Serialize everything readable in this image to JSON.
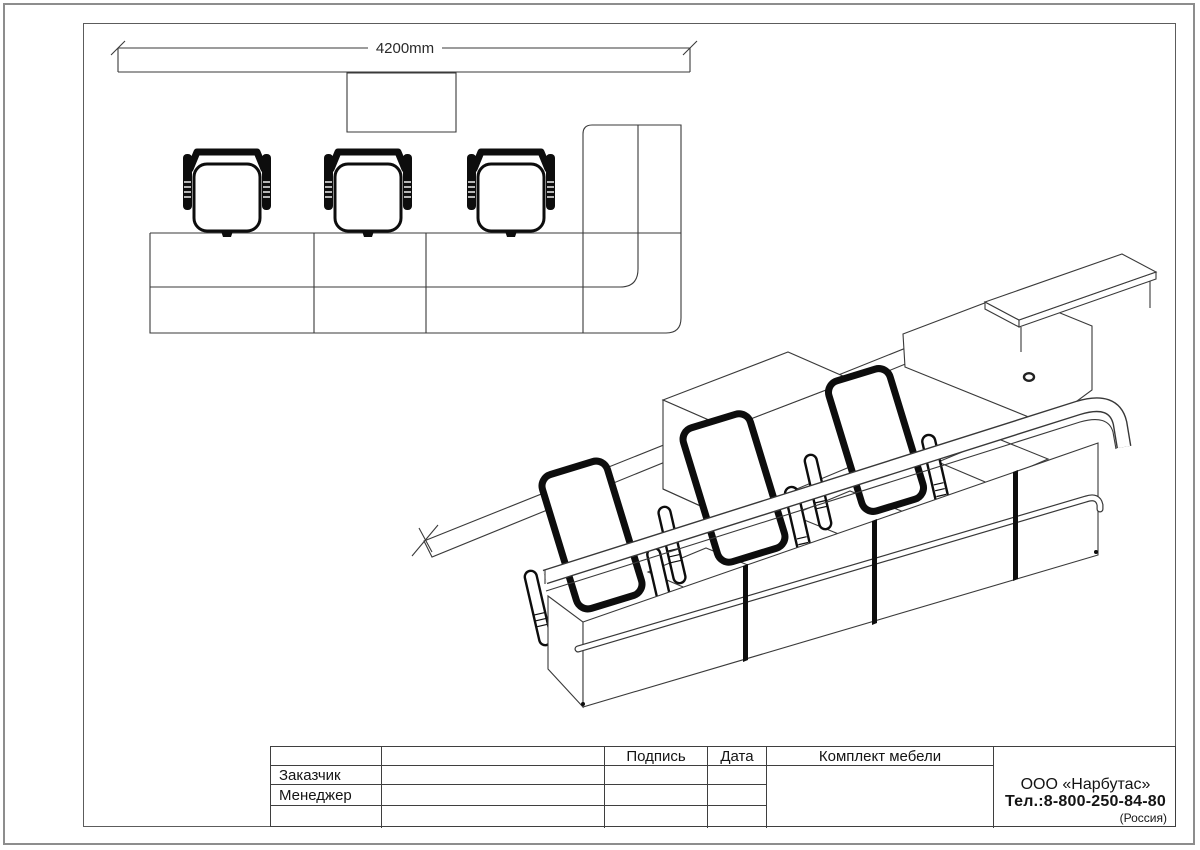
{
  "colors": {
    "line": "#3a3a3a",
    "black_fill": "#0d0d0d",
    "frame": "#5c5c5c",
    "page_border": "#8d8d8d",
    "background": "#ffffff"
  },
  "plan": {
    "dimension": "4200mm"
  },
  "title_block": {
    "signature": "Подпись",
    "date": "Дата",
    "set_title": "Комплект мебели",
    "rows": [
      "Заказчик",
      "Менеджер"
    ],
    "company": {
      "name": "ООО «Нарбутас»",
      "phone": "Тел.:8-800-250-84-80",
      "country": "(Россия)"
    }
  }
}
